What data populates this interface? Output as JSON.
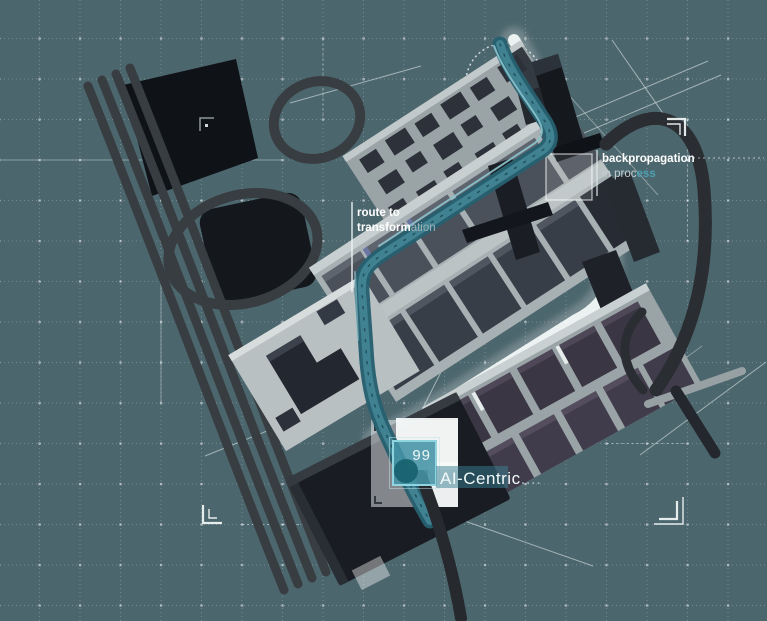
{
  "colors": {
    "background": "#4c666d",
    "accent_teal": "#418493",
    "teal_dark": "#27606f",
    "teal_highlight": "#8cc3cd",
    "badge_fill": "#4493a5",
    "badge_border": "#8fd4de",
    "band_fill": "#3a8093",
    "road_dark": "#383d41",
    "road_white": "#f2f7f7",
    "building_dark": "#0f1217",
    "block_light": "#a7b0b2",
    "roof_dark": "#3b3644",
    "label_faded": "#9fb0b5",
    "backprop_accent": "#4d9fb2"
  },
  "labels": {
    "route": {
      "line1": "route to",
      "line2_strong": "transform",
      "line2_faded": "ation"
    },
    "backprop": {
      "line1": "backpropagation",
      "line2_prefix": "in proc",
      "line2_accent": "ess"
    },
    "badge": {
      "value": "99"
    },
    "ai_centric": {
      "text": "AI-Centric",
      "trail": "...."
    }
  },
  "icons": {
    "corner_bracket": "L-shaped viewfinder bracket",
    "dot_marker": "small square grid dot"
  }
}
